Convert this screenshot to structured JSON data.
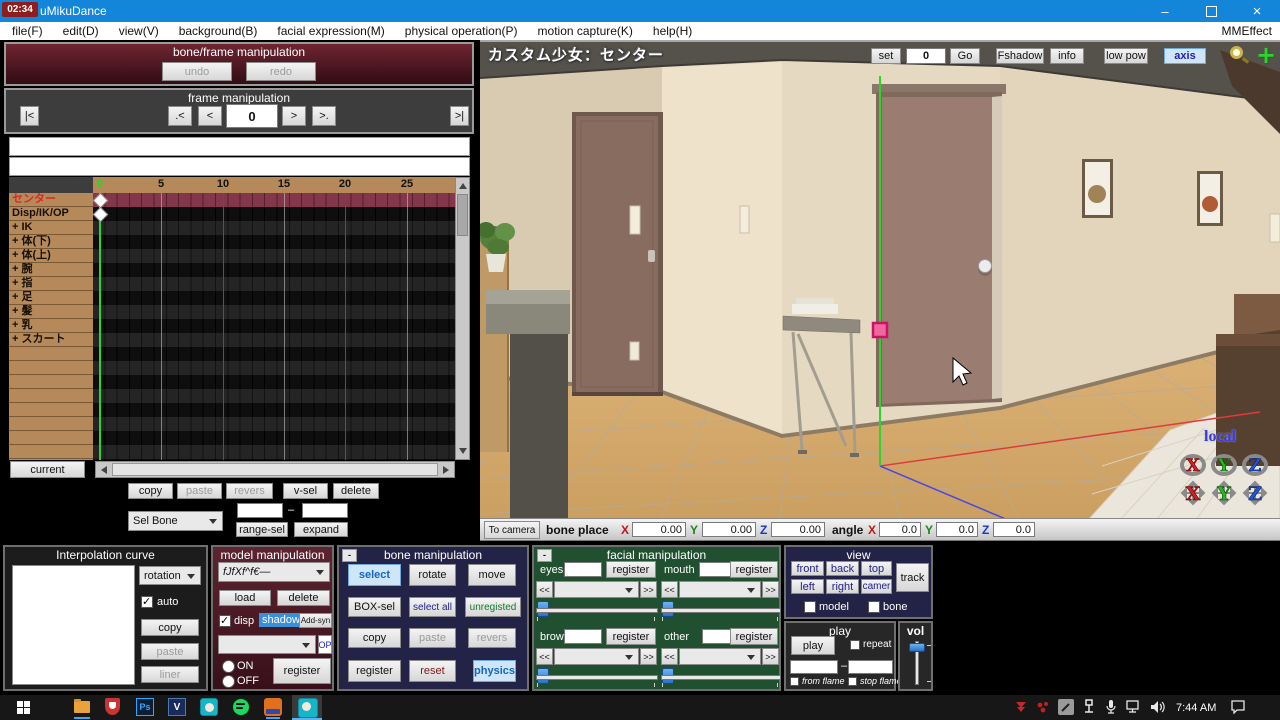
{
  "window": {
    "overlay_time": "02:34",
    "title": "uMikuDance",
    "minimize": "–",
    "close": "×"
  },
  "menubar": {
    "items": [
      "file(F)",
      "edit(D)",
      "view(V)",
      "background(B)",
      "facial expression(M)",
      "physical operation(P)",
      "motion capture(K)",
      "help(H)"
    ],
    "right": "MMEffect"
  },
  "bone_frame_panel": {
    "title": "bone/frame manipulation",
    "undo": "undo",
    "redo": "redo"
  },
  "frame_panel": {
    "title": "frame manipulation",
    "first": "|<",
    "prev_key": ".<",
    "prev": "<",
    "value": "0",
    "next": ">",
    "next_key": ">.",
    "last": ">|"
  },
  "timeline": {
    "ticks": [
      "0",
      "5",
      "10",
      "15",
      "20",
      "25"
    ],
    "rows": [
      {
        "label": "センター",
        "selected": true
      },
      {
        "label": "Disp/IK/OP"
      },
      {
        "label": "+ IK"
      },
      {
        "label": "+ 体(下)"
      },
      {
        "label": "+ 体(上)"
      },
      {
        "label": "+ 腕"
      },
      {
        "label": "+ 指"
      },
      {
        "label": "+ 足"
      },
      {
        "label": "+ 髪"
      },
      {
        "label": "+ 乳"
      },
      {
        "label": "+ スカート"
      }
    ],
    "current_button": "current"
  },
  "timeline_tools": {
    "copy": "copy",
    "paste": "paste",
    "revers": "revers",
    "v_sel": "v-sel",
    "delete": "delete",
    "sel_bone": "Sel Bone",
    "dash": "–",
    "range_sel": "range-sel",
    "expand": "expand"
  },
  "viewport": {
    "model_label": "カスタム少女：センター",
    "set": "set",
    "frame_value": "0",
    "go": "Go",
    "fshadow": "Fshadow",
    "info": "info",
    "low_pow": "low pow",
    "axis": "axis",
    "local_label": "local"
  },
  "status_bar": {
    "to_camera": "To camera",
    "bone_place": "bone place",
    "x": "X",
    "y": "Y",
    "z": "Z",
    "place_x": "0.00",
    "place_y": "0.00",
    "place_z": "0.00",
    "angle": "angle",
    "angle_x": "0.0",
    "angle_y": "0.0",
    "angle_z": "0.0"
  },
  "interpolation": {
    "title": "Interpolation curve",
    "rotation": "rotation",
    "auto": "auto",
    "copy": "copy",
    "paste": "paste",
    "liner": "liner"
  },
  "model_manip": {
    "title": "model manipulation",
    "model_dropdown": "fJfXf^f€―",
    "load": "load",
    "delete": "delete",
    "disp": "disp",
    "shadow": "shadow",
    "add_syn": "Add-syn",
    "op": "OP",
    "on": "ON",
    "off": "OFF",
    "register": "register"
  },
  "bone_manip": {
    "title": "bone manipulation",
    "minimize": "-",
    "select": "select",
    "rotate": "rotate",
    "move": "move",
    "box_sel": "BOX-sel",
    "select_all": "select all",
    "unregisted": "unregisted",
    "copy": "copy",
    "paste": "paste",
    "revers": "revers",
    "register": "register",
    "reset": "reset",
    "physics": "physics"
  },
  "facial": {
    "title": "facial manipulation",
    "minimize": "-",
    "register": "register",
    "prev": "<<",
    "next": ">>",
    "sections": {
      "eyes": "eyes",
      "mouth": "mouth",
      "brow": "brow",
      "other": "other"
    }
  },
  "view_panel": {
    "title": "view",
    "front": "front",
    "back": "back",
    "top": "top",
    "left": "left",
    "right": "right",
    "camer": "camer",
    "track": "track",
    "model": "model",
    "bone": "bone"
  },
  "play_panel": {
    "title": "play",
    "play": "play",
    "repeat": "repeat",
    "dash": "–",
    "from_flame": "from flame",
    "stop_flame": "stop flame"
  },
  "vol_panel": {
    "title": "vol"
  },
  "taskbar": {
    "time": "7:44 AM"
  },
  "colors": {
    "titlebar": "#1486d9",
    "axis_green": "#2ed42e",
    "frame_line_blue": "#4646c8",
    "selected_row": "#7c3140",
    "selection_square": "#f0679f",
    "maroon_panel": "#54212c",
    "navy_panel": "#232347",
    "green_panel": "#20502f"
  }
}
